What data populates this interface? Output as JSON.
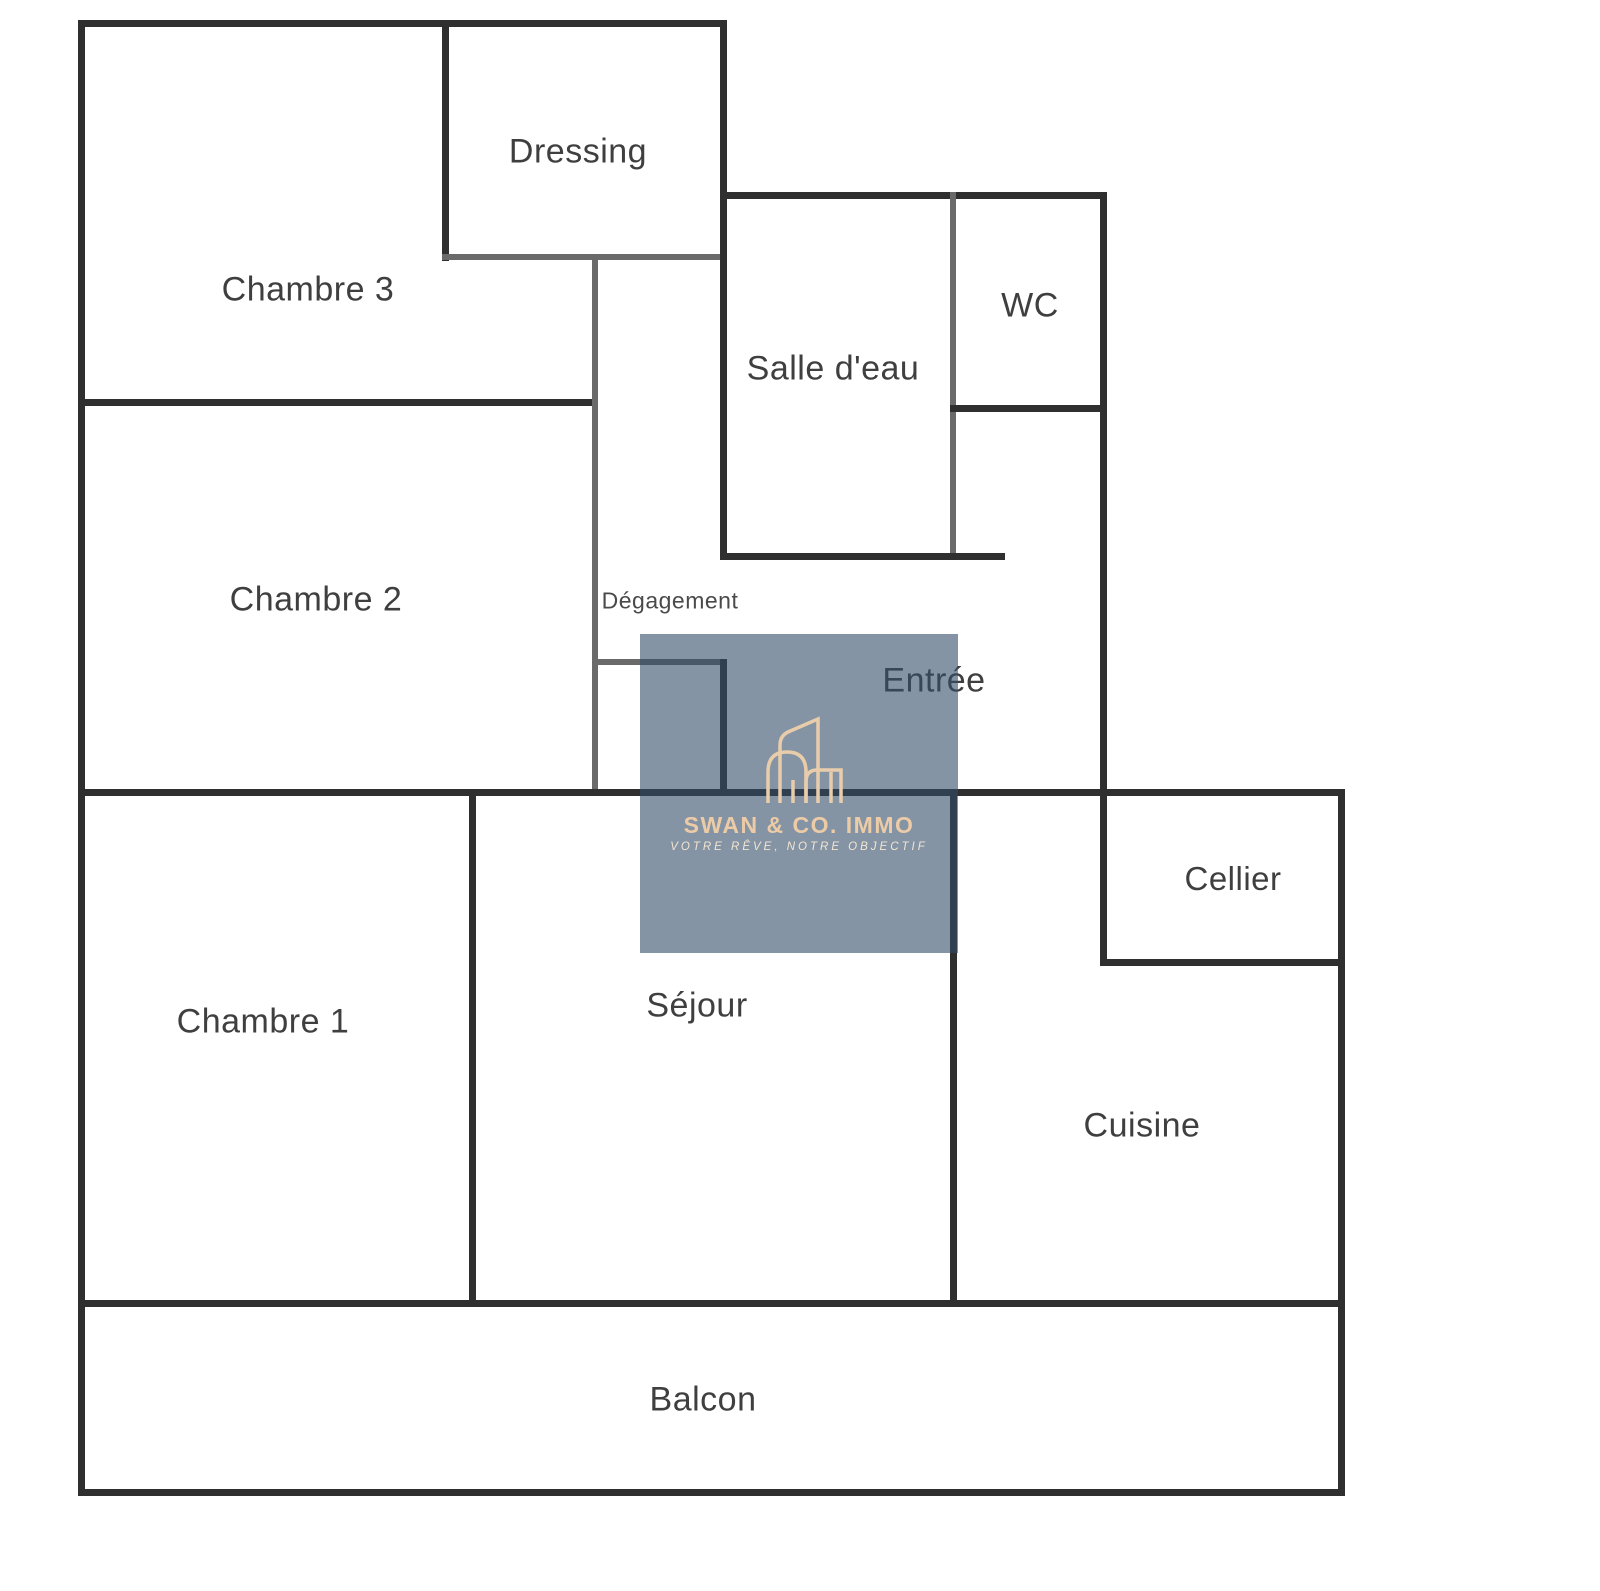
{
  "diagram": {
    "type": "apartment-floor-plan",
    "rooms": [
      {
        "label": "Dressing"
      },
      {
        "label": "Chambre 3"
      },
      {
        "label": "Salle d'eau"
      },
      {
        "label": "WC"
      },
      {
        "label": "Chambre 2"
      },
      {
        "label": "Dégagement"
      },
      {
        "label": "Entrée"
      },
      {
        "label": "Cellier"
      },
      {
        "label": "Chambre 1"
      },
      {
        "label": "Séjour"
      },
      {
        "label": "Cuisine"
      },
      {
        "label": "Balcon"
      }
    ],
    "colors": {
      "background": "#ffffff",
      "wall_dark": "#2f2f2f",
      "wall_gray": "#6a6a6a",
      "label": "#3f3f3f"
    }
  },
  "watermark": {
    "title": "SWAN & CO. IMMO",
    "tagline": "VOTRE RÊVE, NOTRE OBJECTIF",
    "logo_icon": "building-outline-icon",
    "colors": {
      "overlay": "rgba(50,77,103,0.6)",
      "accent": "#eccba6",
      "tagline": "#f2e5d2",
      "logo_stroke": "#e9cdab"
    }
  }
}
